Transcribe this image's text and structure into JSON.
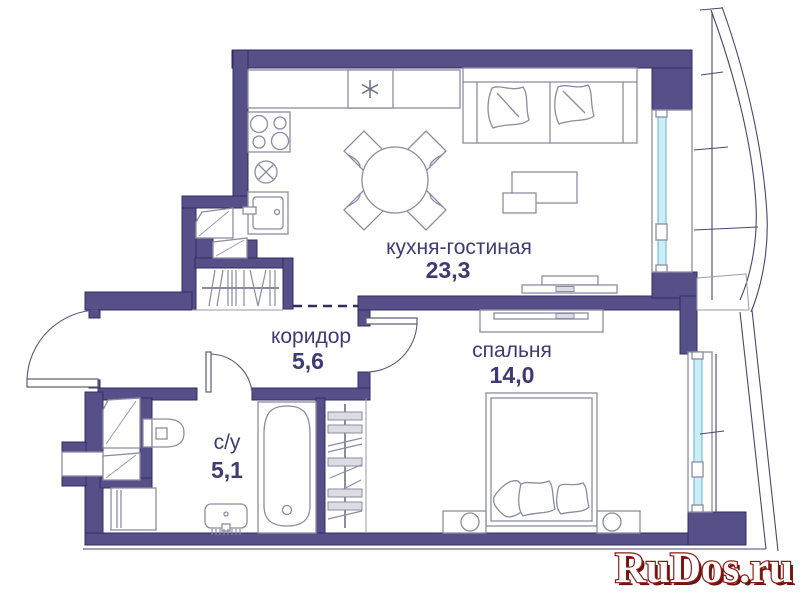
{
  "plan_title": "apartment floor plan",
  "rooms": {
    "kitchen_living": {
      "label": "кухня-гостиная",
      "area": "23,3"
    },
    "corridor": {
      "label": "коридор",
      "area": "5,6"
    },
    "bathroom": {
      "label": "с/у",
      "area": "5,1"
    },
    "bedroom": {
      "label": "спальня",
      "area": "14,0"
    }
  },
  "symbols": {
    "fridge_snowflake_glyph": "✳",
    "sink_cross_glyph": "⊗"
  },
  "watermark": {
    "text": "RuDos.ru",
    "fill": "#ffffff",
    "outline": "#8a1a14",
    "shadow": "#701310"
  },
  "colors": {
    "wall": "#575088",
    "wall_outline": "#312c63",
    "furniture_line": "#8b8ba2",
    "window_glass": "#cdeef7",
    "window_glass_edge": "#62b7cd",
    "label_text": "#3d3c72",
    "background": "#ffffff"
  }
}
